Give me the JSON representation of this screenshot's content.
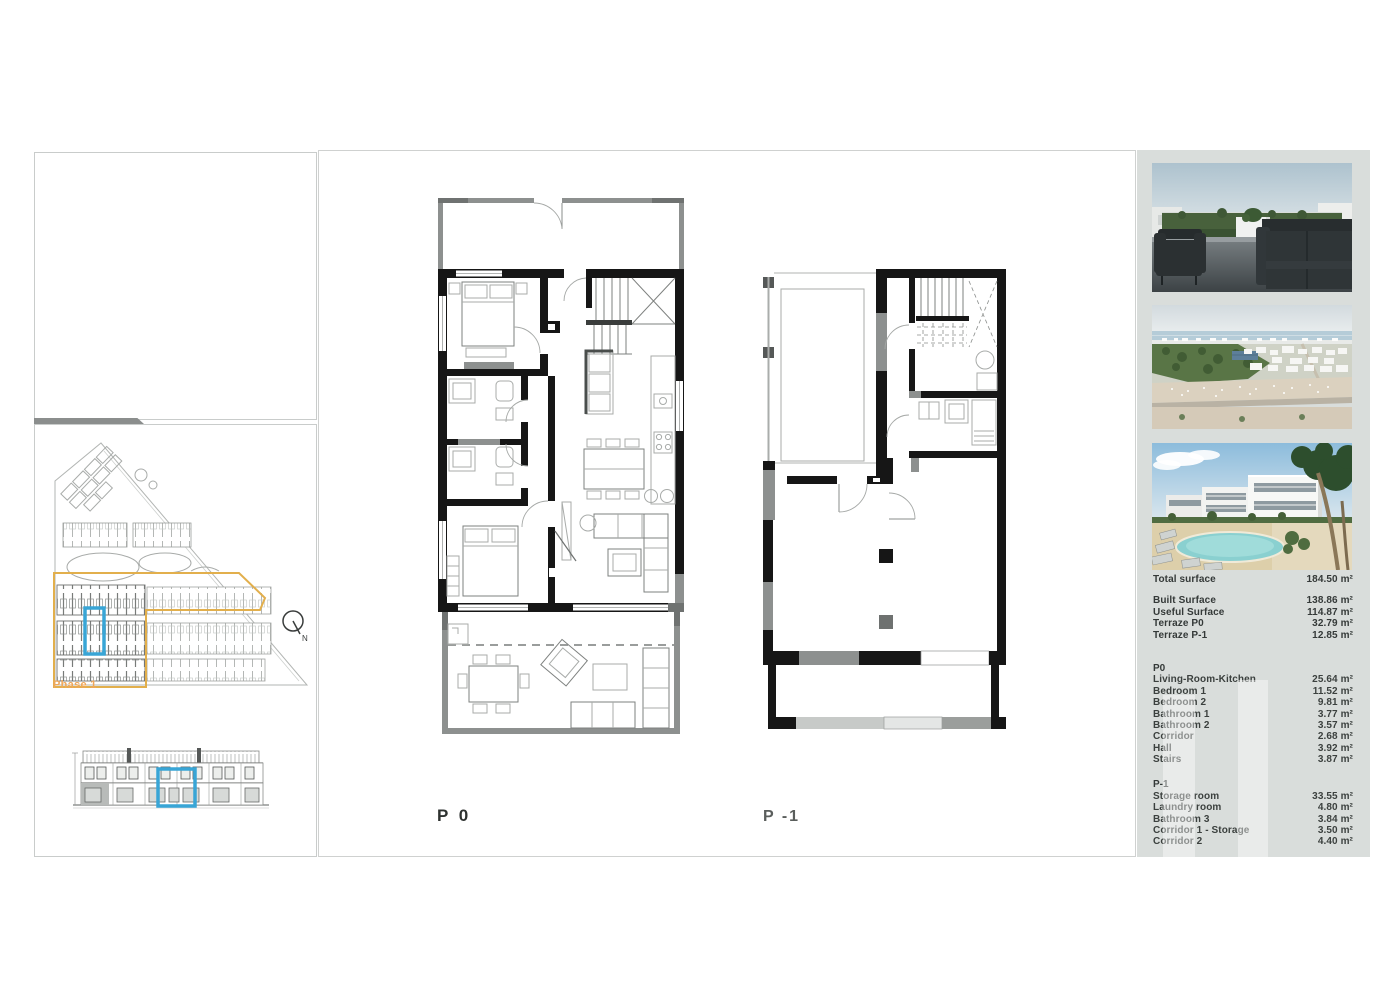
{
  "colors": {
    "accent_blue": "#38a5d6",
    "phase_yellow": "#e2af4c",
    "phase_text": "#efa75a",
    "sidebar_bg": "#d9dddb",
    "wall_black": "#161616"
  },
  "site_plan": {
    "phase_label": "Phase 1",
    "compass_label": "N"
  },
  "plans": {
    "p0": {
      "label": "P 0"
    },
    "p1": {
      "label": "P -1"
    }
  },
  "sidebar": {
    "photos": [
      {
        "name": "roof-terrace-render"
      },
      {
        "name": "aerial-coastline-view"
      },
      {
        "name": "residential-pool-render"
      }
    ],
    "total": {
      "label": "Total surface",
      "value": "184.50 m²"
    },
    "summary_rows": [
      {
        "label": "Built Surface",
        "value": "138.86 m²"
      },
      {
        "label": "Useful Surface",
        "value": "114.87 m²"
      },
      {
        "label": "Terraze P0",
        "value": "32.79 m²"
      },
      {
        "label": "Terraze P-1",
        "value": "12.85 m²"
      }
    ],
    "sections": [
      {
        "title": "P0",
        "rows": [
          {
            "label": "Living-Room-Kitchen",
            "value": "25.64 m²"
          },
          {
            "label": "Bedroom 1",
            "value": "11.52 m²"
          },
          {
            "label": "Bedroom 2",
            "value": "9.81 m²"
          },
          {
            "label": "Bathroom 1",
            "value": "3.77 m²"
          },
          {
            "label": "Bathroom 2",
            "value": "3.57 m²"
          },
          {
            "label": "Corridor",
            "value": "2.68 m²"
          },
          {
            "label": "Hall",
            "value": "3.92 m²"
          },
          {
            "label": "Stairs",
            "value": "3.87 m²"
          }
        ]
      },
      {
        "title": "P-1",
        "rows": [
          {
            "label": "Storage room",
            "value": "33.55 m²"
          },
          {
            "label": "Laundry room",
            "value": "4.80 m²"
          },
          {
            "label": "Bathroom 3",
            "value": "3.84 m²"
          },
          {
            "label": "Corridor 1 - Storage",
            "value": "3.50 m²"
          },
          {
            "label": "Corridor 2",
            "value": "4.40 m²"
          }
        ]
      }
    ]
  }
}
